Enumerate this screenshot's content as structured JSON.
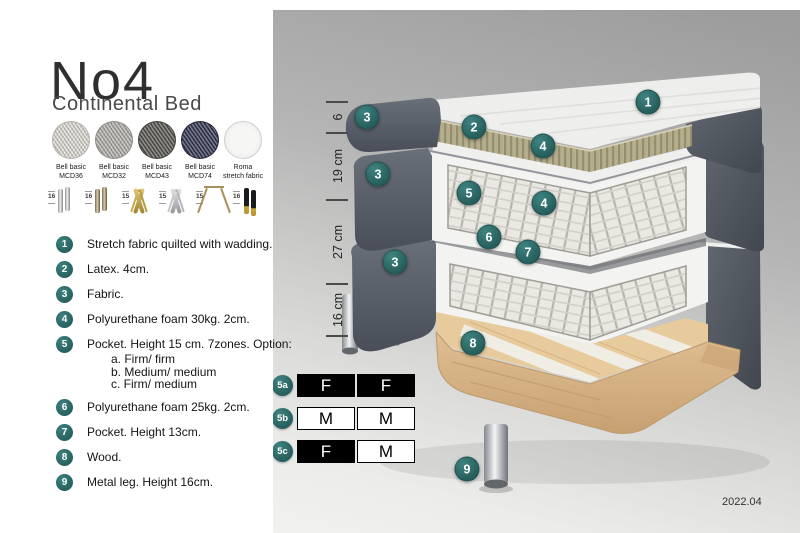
{
  "product": {
    "name": "No4",
    "subtitle": "Continental Bed"
  },
  "colors": {
    "badge_teal": "#2d6d6b",
    "dark_fabric": "#565b66",
    "wood": "#ddbd8e"
  },
  "fabrics": [
    {
      "label1": "Bell basic",
      "label2": "MCD36",
      "color": "#e3e0d8",
      "weave": true
    },
    {
      "label1": "Bell basic",
      "label2": "MCD32",
      "color": "#b4b2ad",
      "weave": true
    },
    {
      "label1": "Bell basic",
      "label2": "MCD43",
      "color": "#57554f",
      "weave": true
    },
    {
      "label1": "Bell basic",
      "label2": "MCD74",
      "color": "#303450",
      "weave": true
    },
    {
      "label1": "Roma",
      "label2": "stretch fabric",
      "color": "#f6f6f5",
      "weave": false
    }
  ],
  "legs": [
    {
      "height": "16",
      "type": "cyl-pair-silver"
    },
    {
      "height": "16",
      "type": "cyl-pair-bronze"
    },
    {
      "height": "15",
      "type": "twist-gold"
    },
    {
      "height": "15",
      "type": "twist-silver"
    },
    {
      "height": "15",
      "type": "hairpin-gold"
    },
    {
      "height": "16",
      "type": "taper-black-gold"
    }
  ],
  "features": [
    {
      "num": "1",
      "text": "Stretch fabric quilted with wadding."
    },
    {
      "num": "2",
      "text": "Latex. 4cm."
    },
    {
      "num": "3",
      "text": "Fabric."
    },
    {
      "num": "4",
      "text": "Polyurethane foam 30kg. 2cm."
    },
    {
      "num": "5",
      "text": "Pocket. Height 15 cm. 7zones. Option:",
      "options": [
        "a. Firm/ firm",
        "b. Medium/ medium",
        "c. Firm/ medium"
      ]
    },
    {
      "num": "6",
      "text": "Polyurethane foam 25kg. 2cm."
    },
    {
      "num": "7",
      "text": "Pocket. Height 13cm."
    },
    {
      "num": "8",
      "text": "Wood."
    },
    {
      "num": "9",
      "text": "Metal leg. Height 16cm."
    }
  ],
  "firmness_options": [
    {
      "id": "5a",
      "cells": [
        {
          "label": "F",
          "filled": true
        },
        {
          "label": "F",
          "filled": true
        }
      ]
    },
    {
      "id": "5b",
      "cells": [
        {
          "label": "M",
          "filled": false
        },
        {
          "label": "M",
          "filled": false
        }
      ]
    },
    {
      "id": "5c",
      "cells": [
        {
          "label": "F",
          "filled": true
        },
        {
          "label": "M",
          "filled": false
        }
      ]
    }
  ],
  "diagram": {
    "measurements": [
      {
        "label": "6",
        "x": 338,
        "y": 117
      },
      {
        "label": "19 cm",
        "x": 338,
        "y": 166
      },
      {
        "label": "27 cm",
        "x": 338,
        "y": 242
      },
      {
        "label": "16 cm",
        "x": 338,
        "y": 310
      }
    ],
    "ticks": [
      {
        "y": 102
      },
      {
        "y": 133
      },
      {
        "y": 200
      },
      {
        "y": 284
      },
      {
        "y": 336
      }
    ],
    "callouts": [
      {
        "label": "1",
        "x": 648,
        "y": 102
      },
      {
        "label": "3",
        "x": 367,
        "y": 117
      },
      {
        "label": "2",
        "x": 474,
        "y": 127
      },
      {
        "label": "4",
        "x": 543,
        "y": 146
      },
      {
        "label": "3",
        "x": 378,
        "y": 174
      },
      {
        "label": "5",
        "x": 469,
        "y": 193
      },
      {
        "label": "4",
        "x": 544,
        "y": 203
      },
      {
        "label": "6",
        "x": 489,
        "y": 237
      },
      {
        "label": "7",
        "x": 528,
        "y": 252
      },
      {
        "label": "3",
        "x": 395,
        "y": 262
      },
      {
        "label": "8",
        "x": 473,
        "y": 343
      },
      {
        "label": "9",
        "x": 467,
        "y": 469
      }
    ],
    "version": "2022.04"
  }
}
